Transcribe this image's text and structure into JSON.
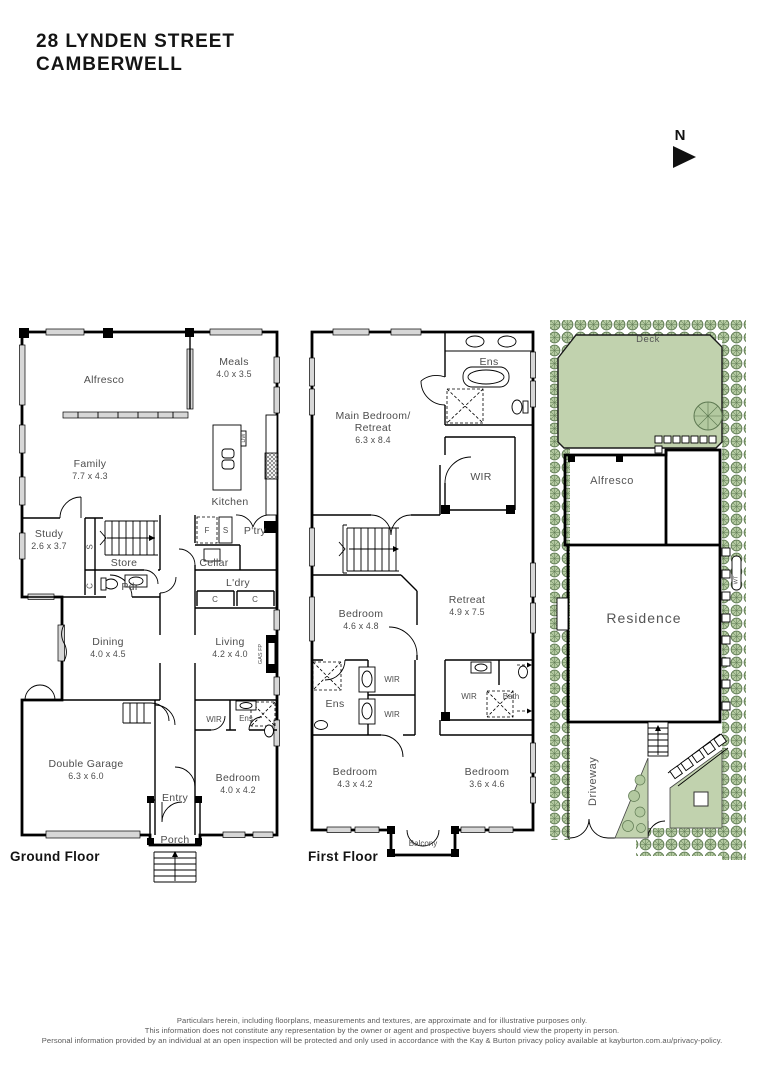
{
  "title": {
    "line1": "28 LYNDEN STREET",
    "line2": "CAMBERWELL"
  },
  "compass": {
    "north_label": "N"
  },
  "ground_floor": {
    "label": "Ground Floor",
    "rooms": {
      "alfresco": {
        "name": "Alfresco"
      },
      "meals": {
        "name": "Meals",
        "dim": "4.0 x 3.5"
      },
      "family": {
        "name": "Family",
        "dim": "7.7 x 4.3"
      },
      "kitchen": {
        "name": "Kitchen"
      },
      "dw": {
        "name": "DW"
      },
      "fridge": {
        "name": "F"
      },
      "sink": {
        "name": "S"
      },
      "pantry": {
        "name": "P'try"
      },
      "cellar": {
        "name": "Cellar"
      },
      "laundry": {
        "name": "L'dry"
      },
      "cupboard1": {
        "name": "C"
      },
      "cupboard2": {
        "name": "C"
      },
      "study": {
        "name": "Study",
        "dim": "2.6 x 3.7"
      },
      "closet_s": {
        "name": "S"
      },
      "closet_c": {
        "name": "C"
      },
      "store": {
        "name": "Store"
      },
      "powder": {
        "name": "Pdr"
      },
      "dining": {
        "name": "Dining",
        "dim": "4.0 x 4.5"
      },
      "living": {
        "name": "Living",
        "dim": "4.2 x 4.0"
      },
      "gas_fp": {
        "name": "GAS FP"
      },
      "garage": {
        "name": "Double Garage",
        "dim": "6.3 x 6.0"
      },
      "entry": {
        "name": "Entry"
      },
      "porch": {
        "name": "Porch"
      },
      "wir": {
        "name": "WIR"
      },
      "ens": {
        "name": "Ens"
      },
      "bedroom": {
        "name": "Bedroom",
        "dim": "4.0 x 4.2"
      }
    }
  },
  "first_floor": {
    "label": "First Floor",
    "rooms": {
      "main_bedroom": {
        "name1": "Main Bedroom/",
        "name2": "Retreat",
        "dim": "6.3 x 8.4"
      },
      "ens_main": {
        "name": "Ens"
      },
      "wir_main": {
        "name": "WIR"
      },
      "bedroom1": {
        "name": "Bedroom",
        "dim": "4.6 x 4.8"
      },
      "retreat": {
        "name": "Retreat",
        "dim": "4.9 x 7.5"
      },
      "ens2": {
        "name": "Ens"
      },
      "wir1": {
        "name": "WIR"
      },
      "wir2": {
        "name": "WIR"
      },
      "wir3": {
        "name": "WIR"
      },
      "bath": {
        "name": "Bath"
      },
      "bedroom2": {
        "name": "Bedroom",
        "dim": "4.3 x 4.2"
      },
      "bedroom3": {
        "name": "Bedroom",
        "dim": "3.6 x 4.6"
      },
      "balcony": {
        "name": "Balcony"
      }
    }
  },
  "site_plan": {
    "deck": "Deck",
    "alfresco": "Alfresco",
    "residence": "Residence",
    "driveway": "Driveway",
    "water_tank": "WT"
  },
  "footer": {
    "line1": "Particulars herein, including floorplans, measurements and textures, are approximate and for illustrative purposes only.",
    "line2": "This information does not constitute any representation by the owner or agent and prospective buyers should view the property in person.",
    "line3": "Personal information provided by an individual at an open inspection will be protected and only used in accordance with the Kay & Burton privacy policy available at kayburton.com.au/privacy-policy."
  },
  "colors": {
    "lawn": "#c1d2ae",
    "shrub_fill": "#b3c9a0",
    "shrub_stroke": "#5e7952",
    "wall": "#000000",
    "label_text": "#4d4d4d"
  }
}
